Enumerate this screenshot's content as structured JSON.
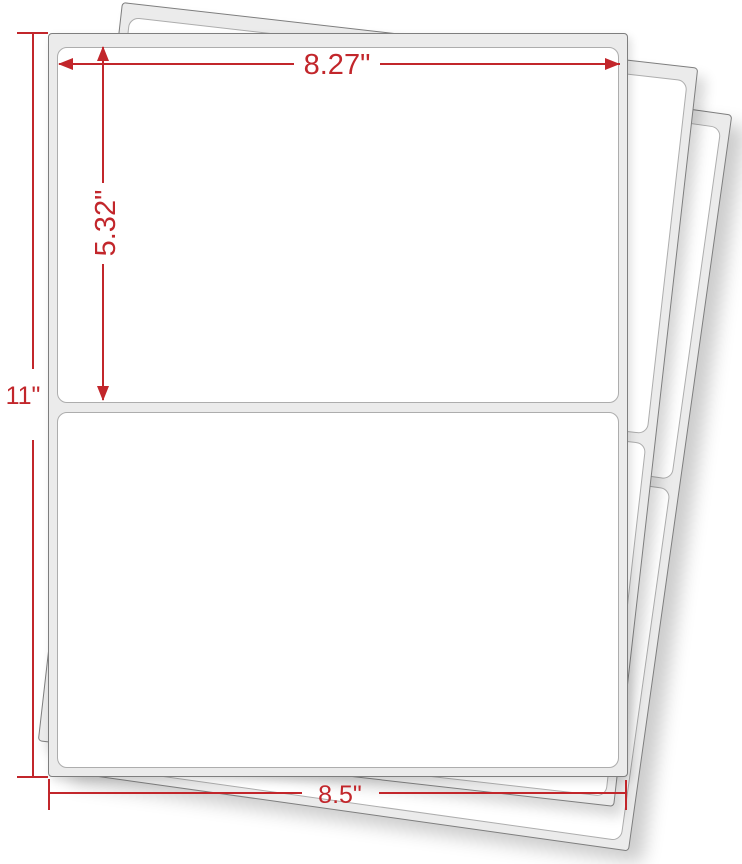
{
  "image_type": "product dimension diagram",
  "subject": "Fanned stack of half-sheet shipping label sheets, two rounded labels per sheet",
  "sheet_count": 3,
  "labels_per_sheet": 2,
  "colors": {
    "annotation_red": "#c2262b",
    "sheet_backing_gray": "#ebebeb",
    "sheet_border_gray": "#7e7e7e",
    "label_border_gray": "#adadad",
    "label_fill": "#ffffff",
    "background": "#ffffff"
  },
  "dimensions": {
    "label_width": {
      "value": "8.27\""
    },
    "label_height": {
      "value": "5.32\""
    },
    "sheet_height": {
      "value": "11\""
    },
    "sheet_width": {
      "value": "8.5\""
    }
  }
}
